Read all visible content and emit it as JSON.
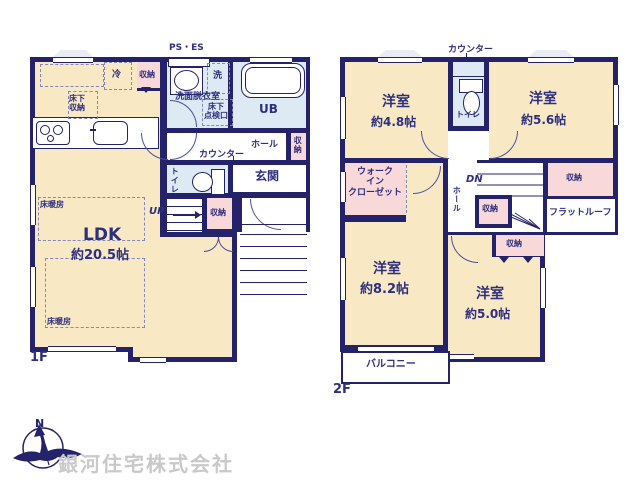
{
  "colors": {
    "wall": "#23226b",
    "text": "#2d2f7f",
    "room": "#f8e9c4",
    "wet": "#dde9f3",
    "closet": "#f8d8d8",
    "dash": "#8286bb",
    "arc": "#4b51a0",
    "company": "#c9c9c9"
  },
  "floor1": {
    "floor_label": "1F",
    "ps_es": "PS・ES",
    "fridge": "冷",
    "kitchen_storage": "収納",
    "underfloor_storage": [
      "床下",
      "収納"
    ],
    "washer": "洗",
    "washroom": "洗面脱衣室",
    "underfloor_hatch": [
      "床下",
      "点検口"
    ],
    "bath": "UB",
    "hall": "ホール",
    "hall_storage": "収納",
    "counter": "カウンター",
    "toilet": "トイレ",
    "entrance": "玄関",
    "stairs": "UP",
    "stairs_storage": "収納",
    "ldk_name": "LDK",
    "ldk_size": "約20.5帖",
    "floor_heating_a": "床暖房",
    "floor_heating_b": "床暖房"
  },
  "floor2": {
    "floor_label": "2F",
    "counter": "カウンター",
    "toilet": "トイレ",
    "rooms": {
      "r48": {
        "name": "洋室",
        "size": "約4.8帖"
      },
      "r56": {
        "name": "洋室",
        "size": "約5.6帖"
      },
      "r82": {
        "name": "洋室",
        "size": "約8.2帖"
      },
      "r50": {
        "name": "洋室",
        "size": "約5.0帖"
      }
    },
    "wic": [
      "ウォーク",
      "イン",
      "クローゼット"
    ],
    "stairs": "DN",
    "hall": "ホール",
    "stairs_storage": "収納",
    "right_storage": "収納",
    "room50_storage": "収納",
    "flat_roof": "フラットルーフ",
    "balcony": "バルコニー"
  },
  "footer": {
    "company": "銀河住宅株式会社",
    "compass_north": "N"
  }
}
